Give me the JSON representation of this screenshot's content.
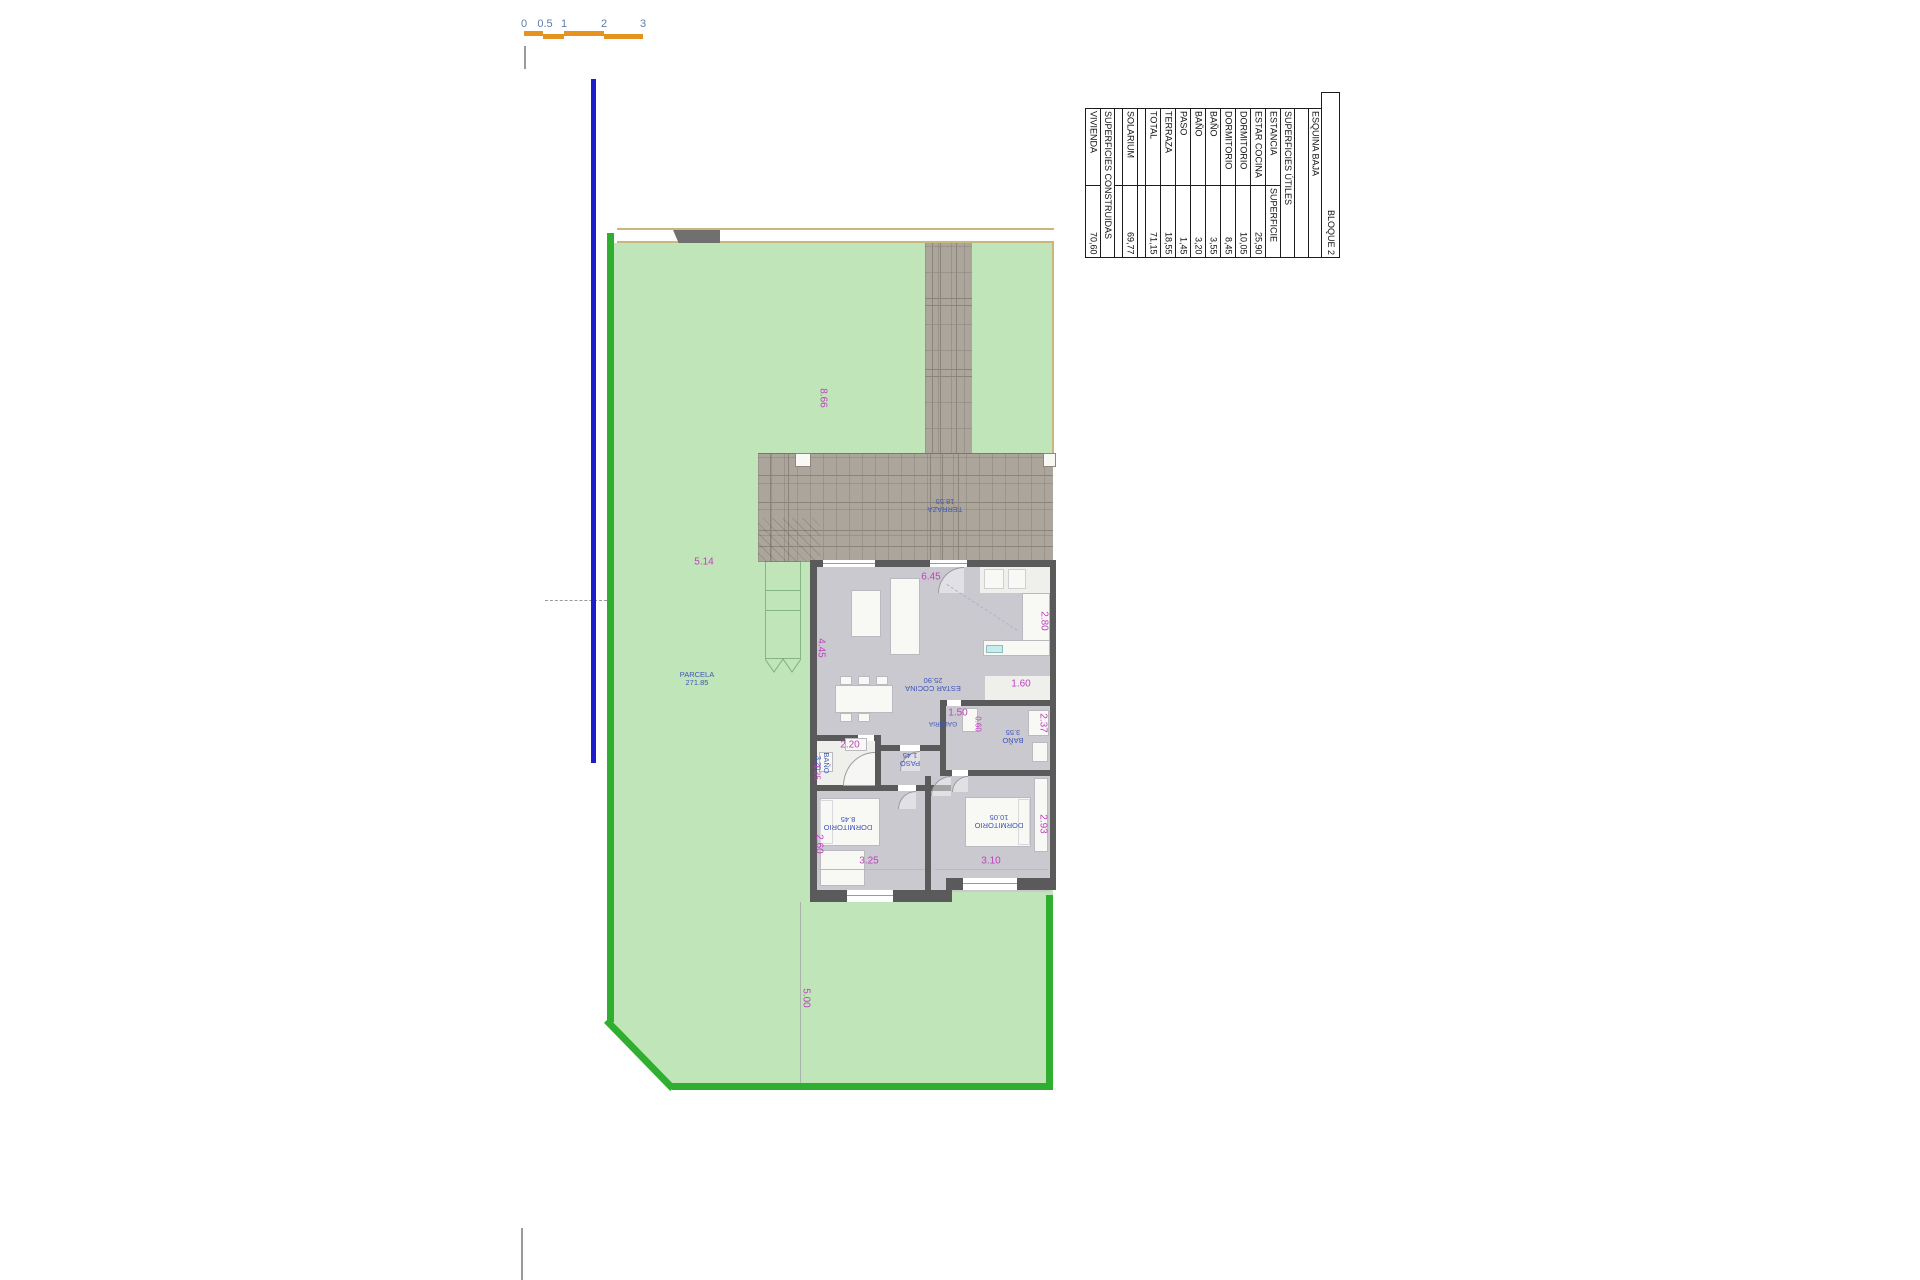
{
  "scale_bar": {
    "ticks": [
      "0",
      "0.5",
      "1",
      "2",
      "3"
    ]
  },
  "summary_table": {
    "title": "BLOQUE 2",
    "subtitle": "ESQUINA BAJA",
    "useful_header": "SUPERFICIES ÚTILES",
    "col_room": "ESTANCIA",
    "col_area": "SUPERFICIE",
    "rooms": [
      {
        "label": "ESTAR COCINA",
        "value": "25,90"
      },
      {
        "label": "DORMITORIO",
        "value": "10,05"
      },
      {
        "label": "DORMITORIO",
        "value": "8,45"
      },
      {
        "label": "BAÑO",
        "value": "3,55"
      },
      {
        "label": "BAÑO",
        "value": "3,20"
      },
      {
        "label": "PASO",
        "value": "1,45"
      },
      {
        "label": "TERRAZA",
        "value": "18,55"
      },
      {
        "label": "TOTAL",
        "value": "71,15"
      }
    ],
    "solarium": {
      "label": "SOLARIUM",
      "value": "69,77"
    },
    "built_header": "SUPERFICIES CONSTRUIDAS",
    "vivienda": {
      "label": "VIVIENDA",
      "value": "70,60"
    }
  },
  "plan": {
    "rooms": {
      "terraza": {
        "name": "TERRAZA",
        "area": "18.55"
      },
      "estar_cocina": {
        "name": "ESTAR COCINA",
        "area": "25.90"
      },
      "galeria": {
        "name": "GALERIA"
      },
      "bano_355": {
        "name": "BAÑO",
        "area": "3.55"
      },
      "bano_320": {
        "name": "BAÑO",
        "area": "3.20"
      },
      "paso": {
        "name": "PASO",
        "area": "1.45"
      },
      "dormitorio_845": {
        "name": "DORMITORIO",
        "area": "8.45"
      },
      "dormitorio_1005": {
        "name": "DORMITORIO",
        "area": "10.05"
      },
      "parcela": {
        "name": "PARCELA",
        "area": "271.85"
      }
    },
    "dimensions": {
      "d866": "8.66",
      "d514": "5.14",
      "d500": "5.00",
      "d645": "6.45",
      "d445": "4.45",
      "d280": "2.80",
      "d160": "1.60",
      "d150": "1.50",
      "d060": "0.60",
      "d237": "2.37",
      "d220": "2.20",
      "d135": "1.35",
      "d260": "2.60",
      "d293": "2.93",
      "d325": "3.25",
      "d310": "3.10"
    }
  },
  "colors": {
    "scale_orange": "#e6921e",
    "scale_number_blue": "#5b7ca8",
    "boundary_blue_line": "#1d1dce",
    "parcel_fill_green": "#bfe5b8",
    "parcel_border_green": "#2fae2f",
    "fence_tan": "#c9b77e",
    "paving_taupe": "#aca59c",
    "wall_gray": "#5a5a5a",
    "floor_gray": "#c9c9cf",
    "room_label_blue": "#4056b8",
    "dimension_magenta": "#c13fc1"
  }
}
